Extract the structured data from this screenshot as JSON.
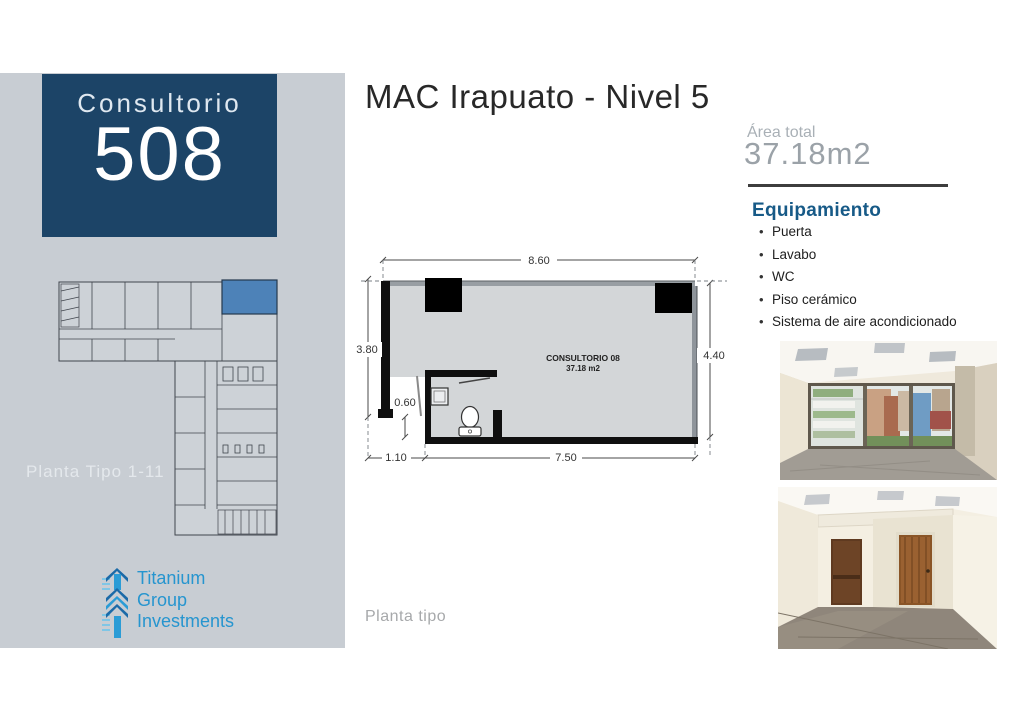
{
  "sidebar": {
    "bg_color": "#c8cdd3",
    "unit_card": {
      "bg_color": "#1c4467",
      "label": "Consultorio",
      "number": "508"
    },
    "mini_plan": {
      "caption": "Planta Tipo 1-11",
      "highlight_color": "#4d82b8"
    },
    "logo": {
      "lines": [
        "Titanium",
        "Group",
        "Investments"
      ],
      "text_color": "#2695cf"
    }
  },
  "header": {
    "title": "MAC Irapuato - Nivel 5"
  },
  "area": {
    "label": "Área total",
    "value": "37.18m2"
  },
  "equipment": {
    "heading": "Equipamiento",
    "heading_color": "#175a87",
    "items": [
      "Puerta",
      "Lavabo",
      "WC",
      "Piso cerámico",
      "Sistema de aire acondicionado"
    ]
  },
  "floor_plan": {
    "caption": "Planta tipo",
    "room_label": "CONSULTORIO 08",
    "room_area": "37.18 m2",
    "dimensions": {
      "top": "8.60",
      "left": "3.80",
      "right": "4.40",
      "bottom": "7.50",
      "entry": "1.10",
      "step": "0.60"
    }
  },
  "photos": [
    {
      "name": "Render interior con ventana"
    },
    {
      "name": "Render interior con puertas"
    }
  ]
}
